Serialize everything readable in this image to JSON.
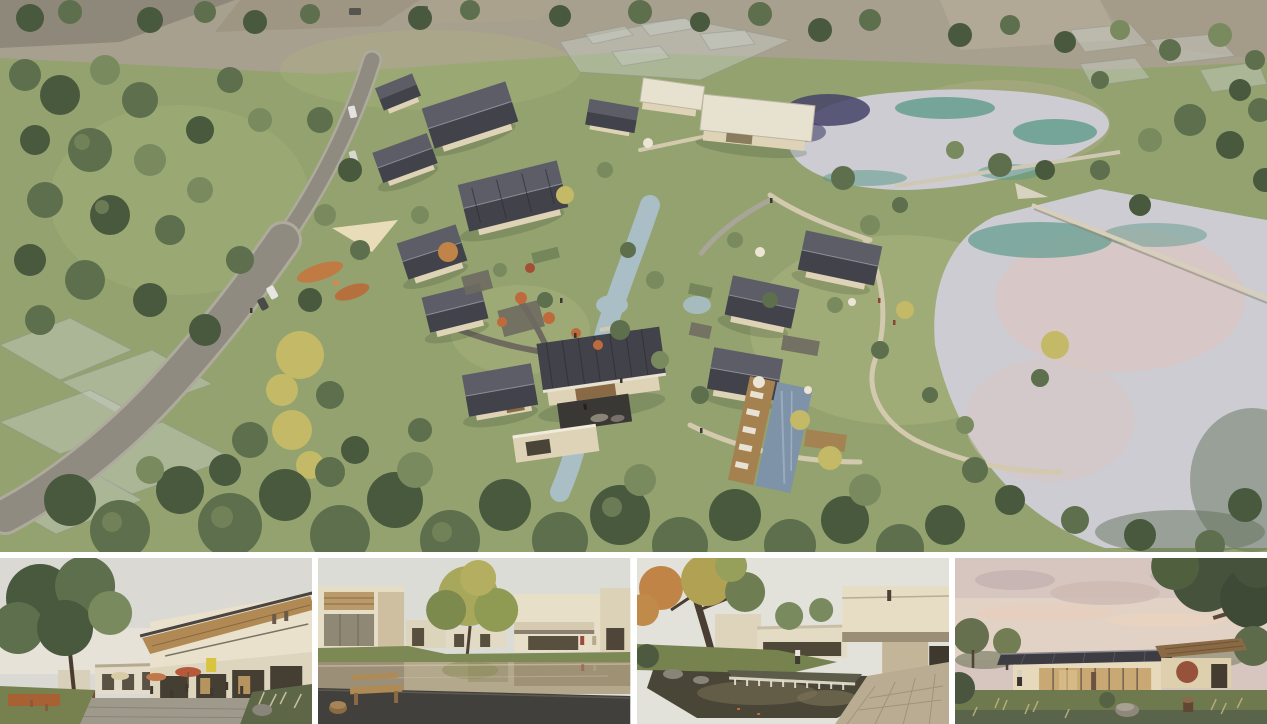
{
  "palette": {
    "frame": "#ffffff",
    "grass": "#93a26e",
    "grassLight": "#adb680",
    "grassDark": "#75875a",
    "field": "#a8a08e",
    "fieldDark": "#8e887a",
    "road": "#8f8b81",
    "roadEdge": "#aeaa9c",
    "path": "#d2c9ae",
    "stone": "#6e6a60",
    "lake": "#ccccd2",
    "lakeTeal": "#5f9a8b",
    "lakePink": "#dcc6c2",
    "lakeDark": "#45436a",
    "stream": "#a9bec5",
    "pool": "#7e93a8",
    "deck": "#a5814f",
    "roof": "#42424a",
    "roofLight": "#5d5d68",
    "wall": "#ded3b6",
    "wallShade": "#c6b999",
    "flatRoof": "#e7e1d0",
    "treeDark": "#49593e",
    "tree": "#5d6f4c",
    "treeLight": "#7a8a5f",
    "treeYellow": "#c3b966",
    "treeOrange": "#c08448",
    "ghostFill": "rgba(202,207,200,0.45)",
    "ghostStroke": "rgba(140,145,140,0.45)",
    "umbrella": "#bf6a3d",
    "umbrellaWhite": "#ece5d4",
    "skyGray": "#dad9d3",
    "skyDusk": "#d7c6c0",
    "waterMirror": "#b3a78c",
    "pondDark": "#4a4637",
    "paving": "#b9ac92"
  },
  "board": {
    "background": "#ffffff",
    "main_view": {
      "name": "aerial-masterplan-rendering",
      "description": "Aerial rendering of a courtyard village resort: clusters of dark gabled-roof houses along a winding stream, swimming-pool terrace with loungers, cafe courtyard with orange umbrellas and playground, a curving access road with cars on the left, two reflective lakes joined by a weir on the right, all set in tree-studded meadows with translucent future-phase buildings."
    },
    "thumbnails": [
      {
        "name": "street-cafe-perspective",
        "description": "Street-level view of a two-storey building with timber shed roof and balcony, cafe terraces with orange umbrellas and seated people beneath a large green tree."
      },
      {
        "name": "reflecting-pool-courtyard",
        "description": "Courtyard with a mirror-like reflecting pool, wooden bench and stump stool on a dark deck, golden tree and cream flat-roofed buildings with two people walking."
      },
      {
        "name": "pond-waterfall-courtyard",
        "description": "Garden courtyard with koi pond and stone weir waterfall, large autumn tree, cantilevered balcony volume with a visitor and stone paving."
      },
      {
        "name": "dusk-pavilion-lawn",
        "description": "Single-storey glass pavilion with dark metal roof glowing warmly at dusk, timber-roofed wing, lawn with rocks, stump and shrubs framed by trees under a pink sky."
      }
    ]
  }
}
